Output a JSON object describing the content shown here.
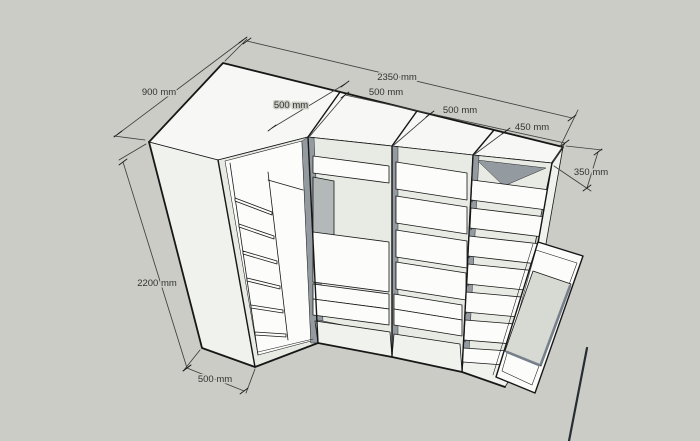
{
  "viewport": {
    "app_style": "sketchup-3d-view",
    "background": "#cbccc6"
  },
  "colors": {
    "bg": "#cbccc6",
    "top": "#f7f8f5",
    "side": "#f0f2ed",
    "white": "#fcfdfb",
    "int": "#e8eae4",
    "shadow": "#949ba0",
    "gray": "#b3b9b9",
    "mirror": "#d7d9d3",
    "edge": "#171717",
    "dim": "#3e3e3c",
    "txt": "#33332f"
  },
  "dimensions": {
    "left_depth_top": "900 mm",
    "total_width": "2350 mm",
    "corner_front_width": "500 mm",
    "section_widths": [
      "500 mm",
      "500 mm",
      "450 mm"
    ],
    "right_depth": "350 mm",
    "height": "2200 mm",
    "left_depth_bottom": "500 mm"
  }
}
